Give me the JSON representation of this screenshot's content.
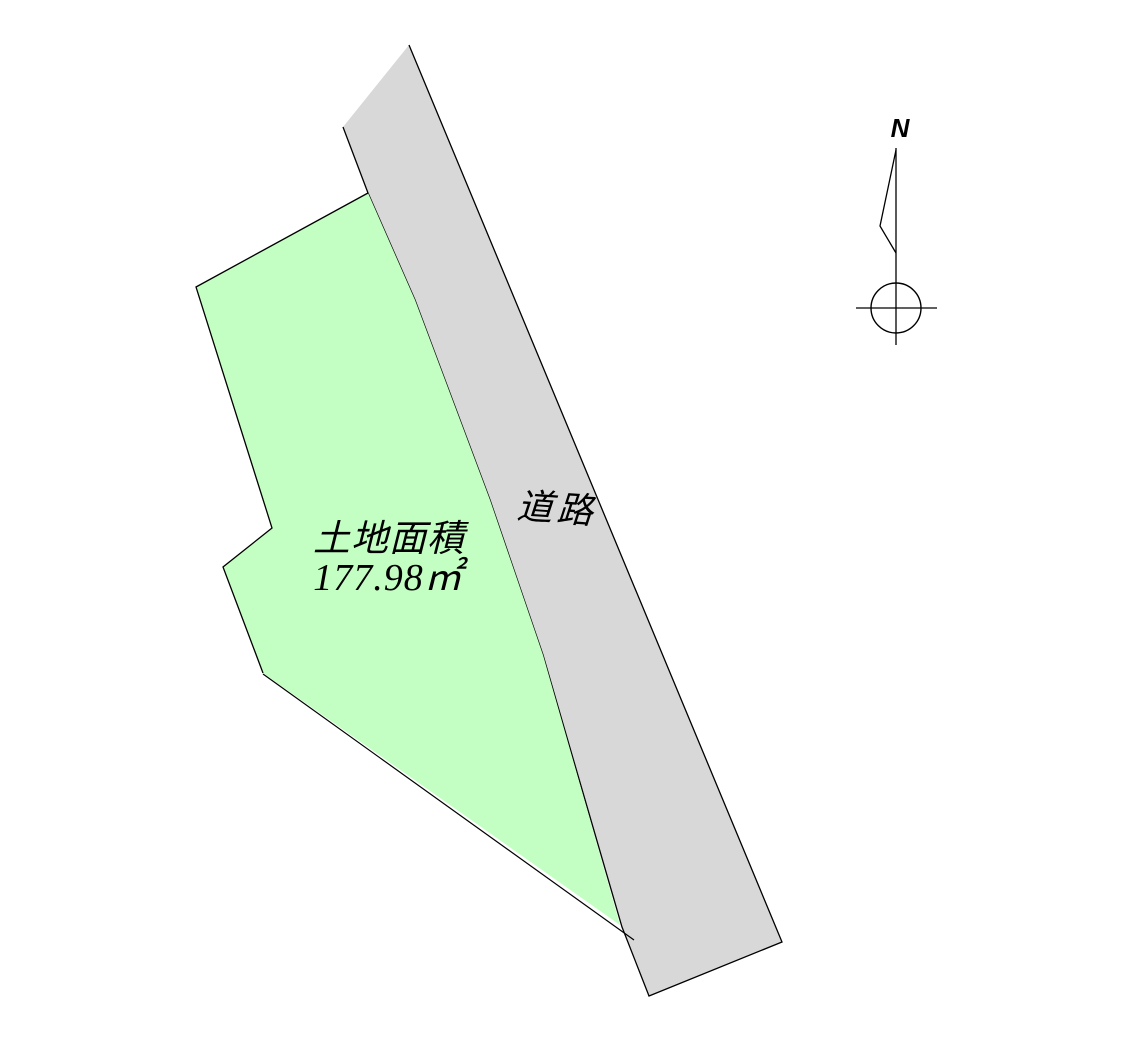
{
  "drawing": {
    "parcel": {
      "area_label": "土地面積",
      "area_value": "177.98㎡",
      "fill_color": "#c3ffc3"
    },
    "road": {
      "label": "道路",
      "fill_color": "#d8d8d8"
    },
    "compass": {
      "north_label": "N"
    },
    "line_color": "#000000",
    "background_color": "#ffffff"
  }
}
